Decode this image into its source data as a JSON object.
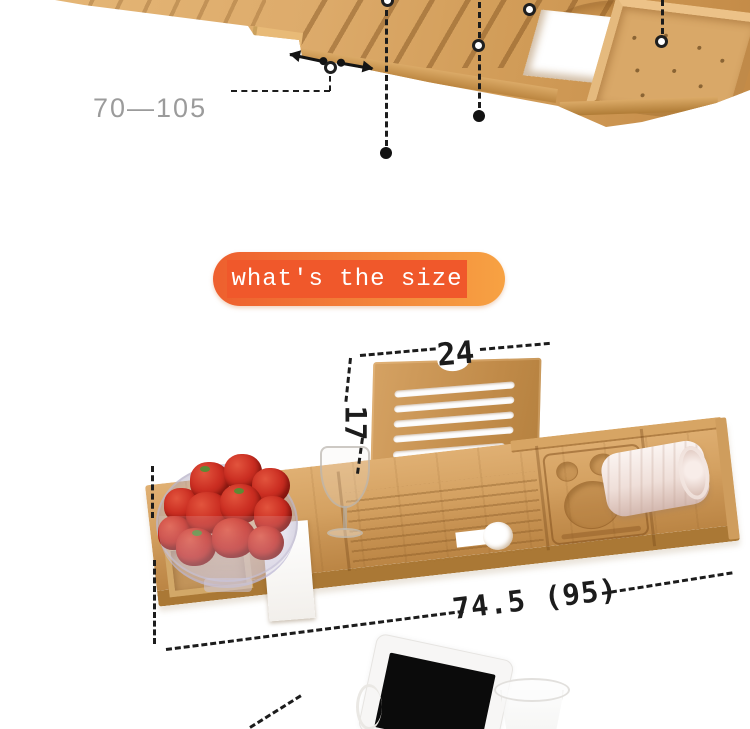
{
  "scene": {
    "type": "product detail image",
    "product": "extendable bamboo bathtub caddy tray",
    "background": "#ffffff"
  },
  "colors": {
    "annotation": "#1c1c1c",
    "muted-label": "#9b9b9b",
    "banner-left": "#ee5f2e",
    "banner-right": "#f7a243",
    "banner-inner": "#f0582b",
    "banner-text": "#ffffff",
    "wood-light": "#e6b878",
    "wood-mid": "#d2a05f",
    "wood-dark": "#b58342",
    "wood-edge": "#aa7835"
  },
  "top_photo": {
    "extension_range_label": "70—105"
  },
  "banner": {
    "label": "what's the size"
  },
  "size_photo": {
    "stand_width_label": "24",
    "stand_height_label": "17",
    "length_label": "74.5 (95)"
  }
}
